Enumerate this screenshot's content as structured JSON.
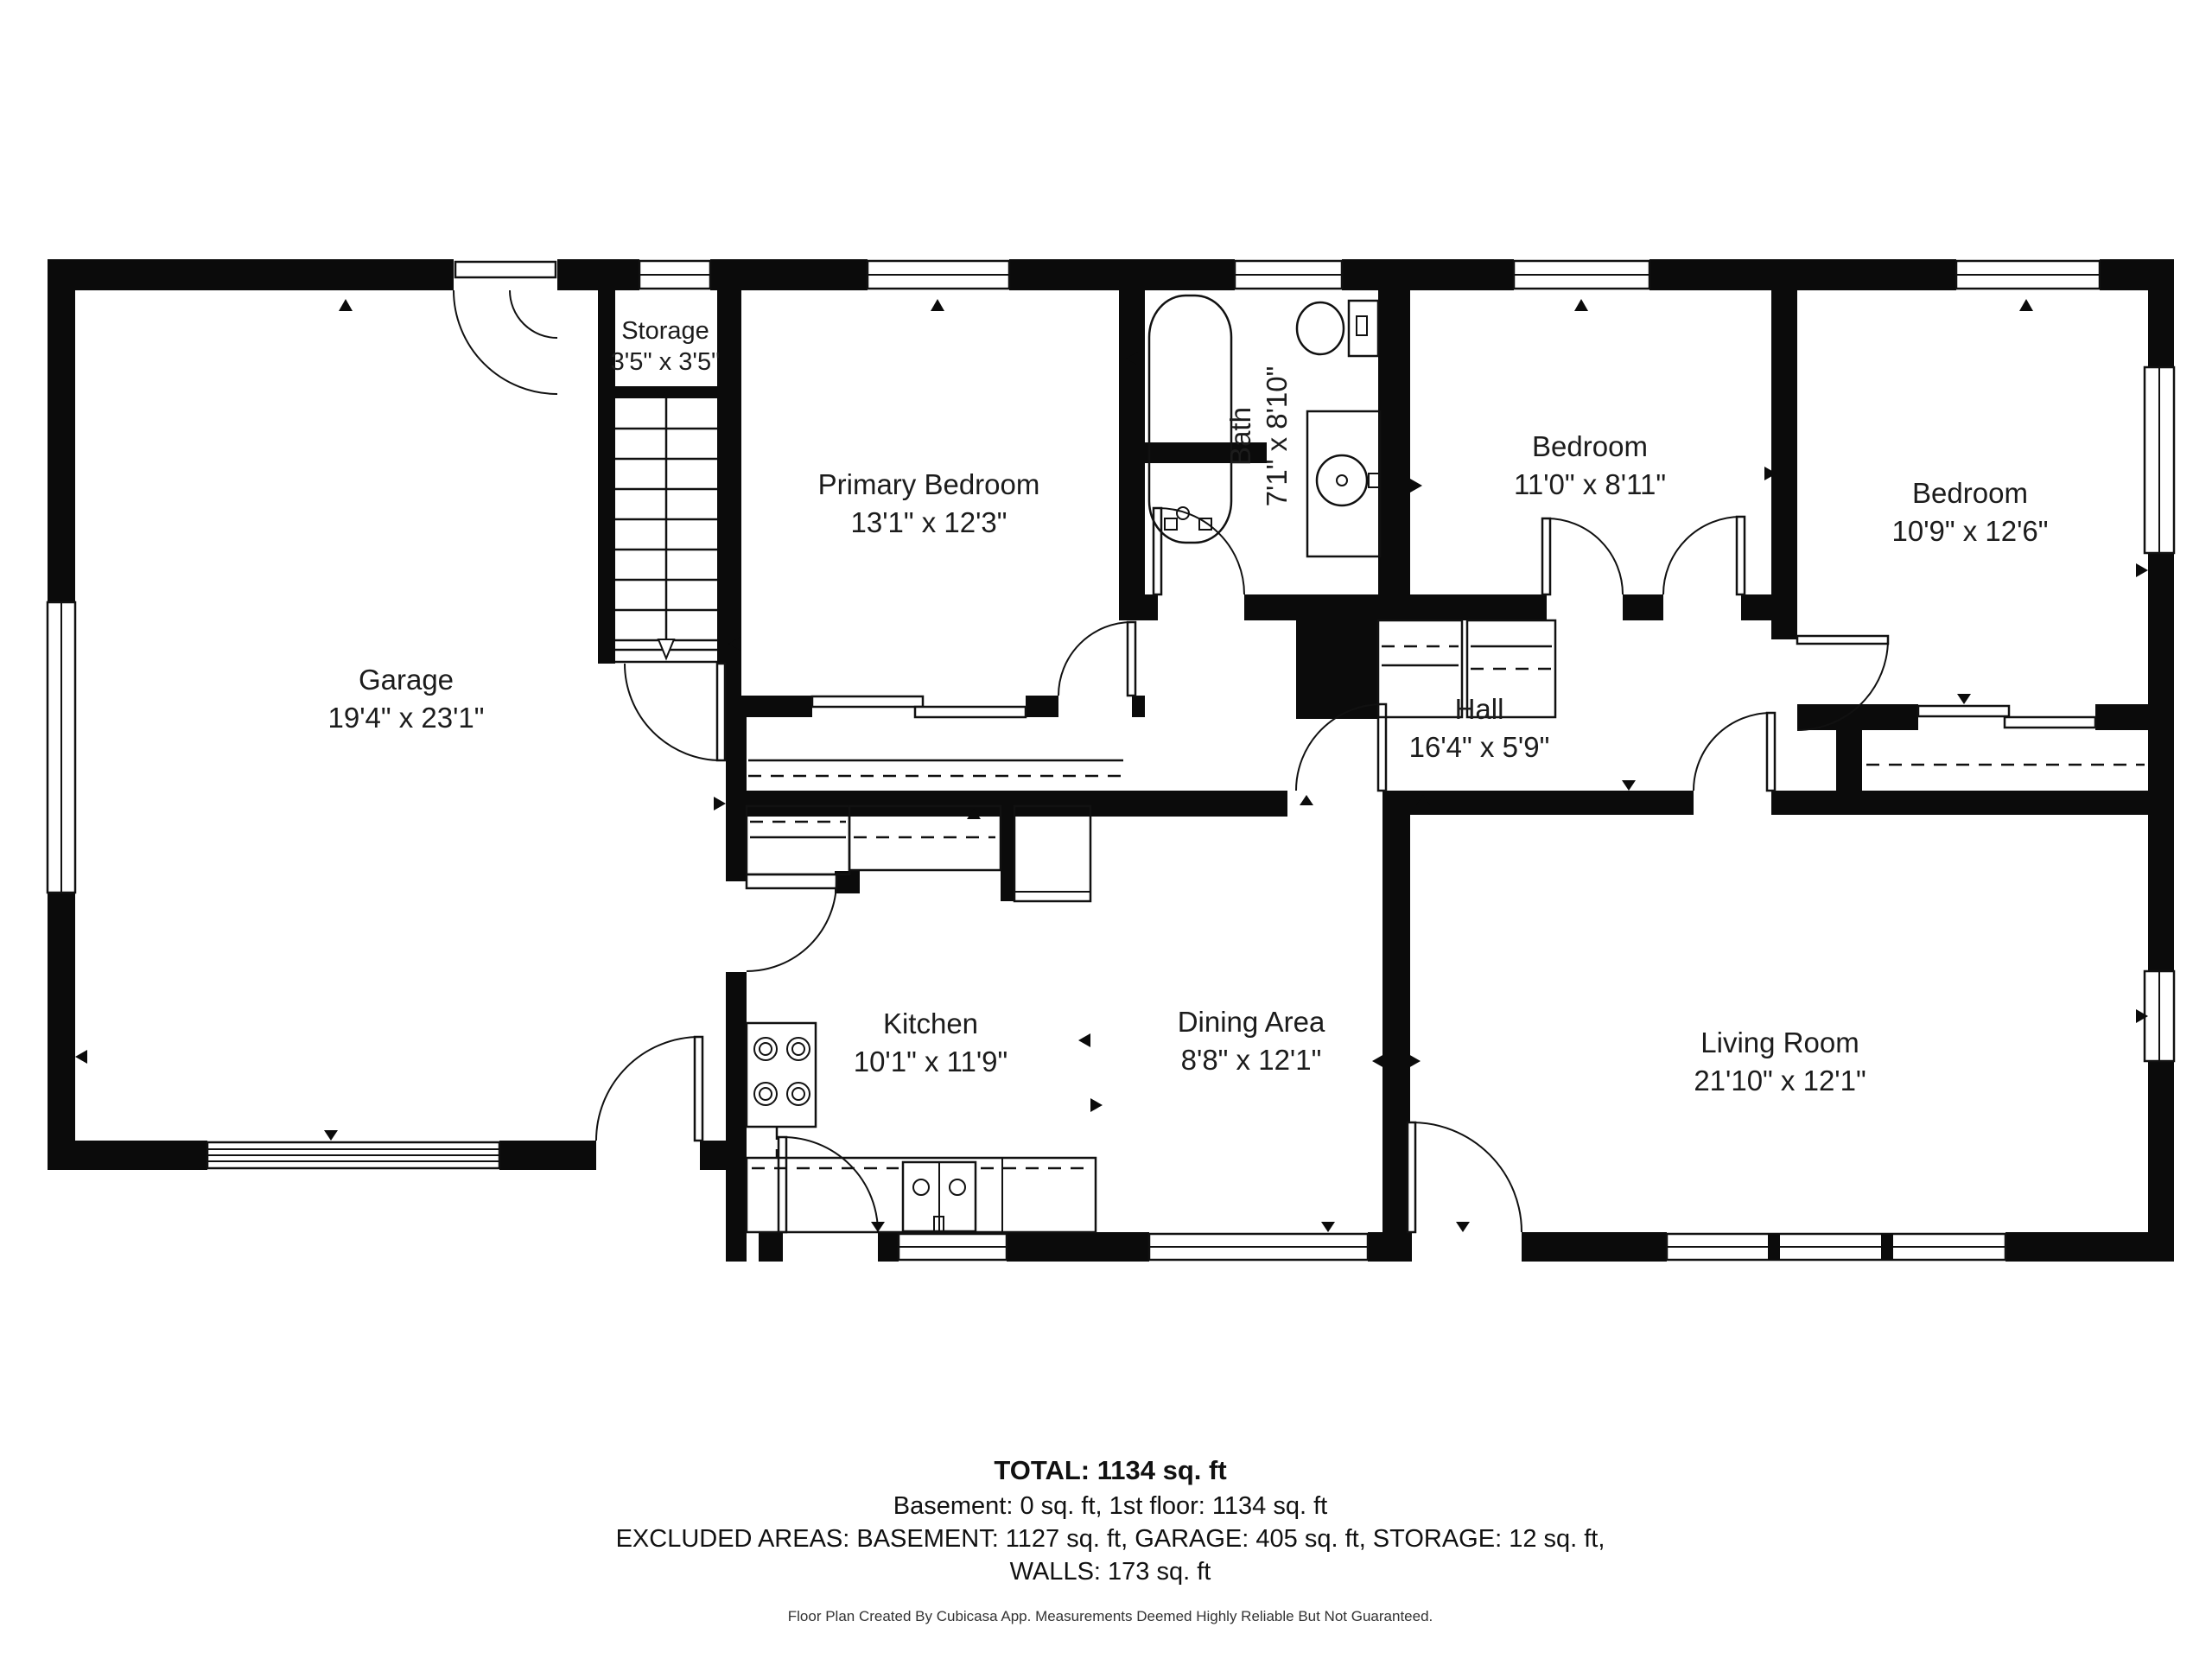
{
  "rooms": {
    "garage": {
      "name": "Garage",
      "dims": "19'4\" x 23'1\""
    },
    "storage": {
      "name": "Storage",
      "dims": "3'5\" x 3'5\""
    },
    "primary_bedroom": {
      "name": "Primary Bedroom",
      "dims": "13'1\" x 12'3\""
    },
    "bath": {
      "name": "Bath",
      "dims": "7'1\" x 8'10\""
    },
    "bedroom_middle": {
      "name": "Bedroom",
      "dims": "11'0\" x 8'11\""
    },
    "bedroom_right": {
      "name": "Bedroom",
      "dims": "10'9\" x 12'6\""
    },
    "hall": {
      "name": "Hall",
      "dims": "16'4\" x 5'9\""
    },
    "kitchen": {
      "name": "Kitchen",
      "dims": "10'1\" x 11'9\""
    },
    "dining": {
      "name": "Dining Area",
      "dims": "8'8\" x 12'1\""
    },
    "living": {
      "name": "Living Room",
      "dims": "21'10\" x 12'1\""
    }
  },
  "summary": {
    "total": "TOTAL: 1134 sq. ft",
    "floors": "Basement: 0 sq. ft, 1st floor: 1134 sq. ft",
    "excluded": "EXCLUDED AREAS: BASEMENT: 1127 sq. ft, GARAGE: 405 sq. ft, STORAGE: 12 sq. ft,",
    "walls": "WALLS: 173 sq. ft",
    "footer": "Floor Plan Created By Cubicasa App. Measurements Deemed Highly Reliable But Not Guaranteed."
  },
  "colors": {
    "wall": "#0b0b0b",
    "background": "#ffffff",
    "text": "#1c1c1c"
  }
}
